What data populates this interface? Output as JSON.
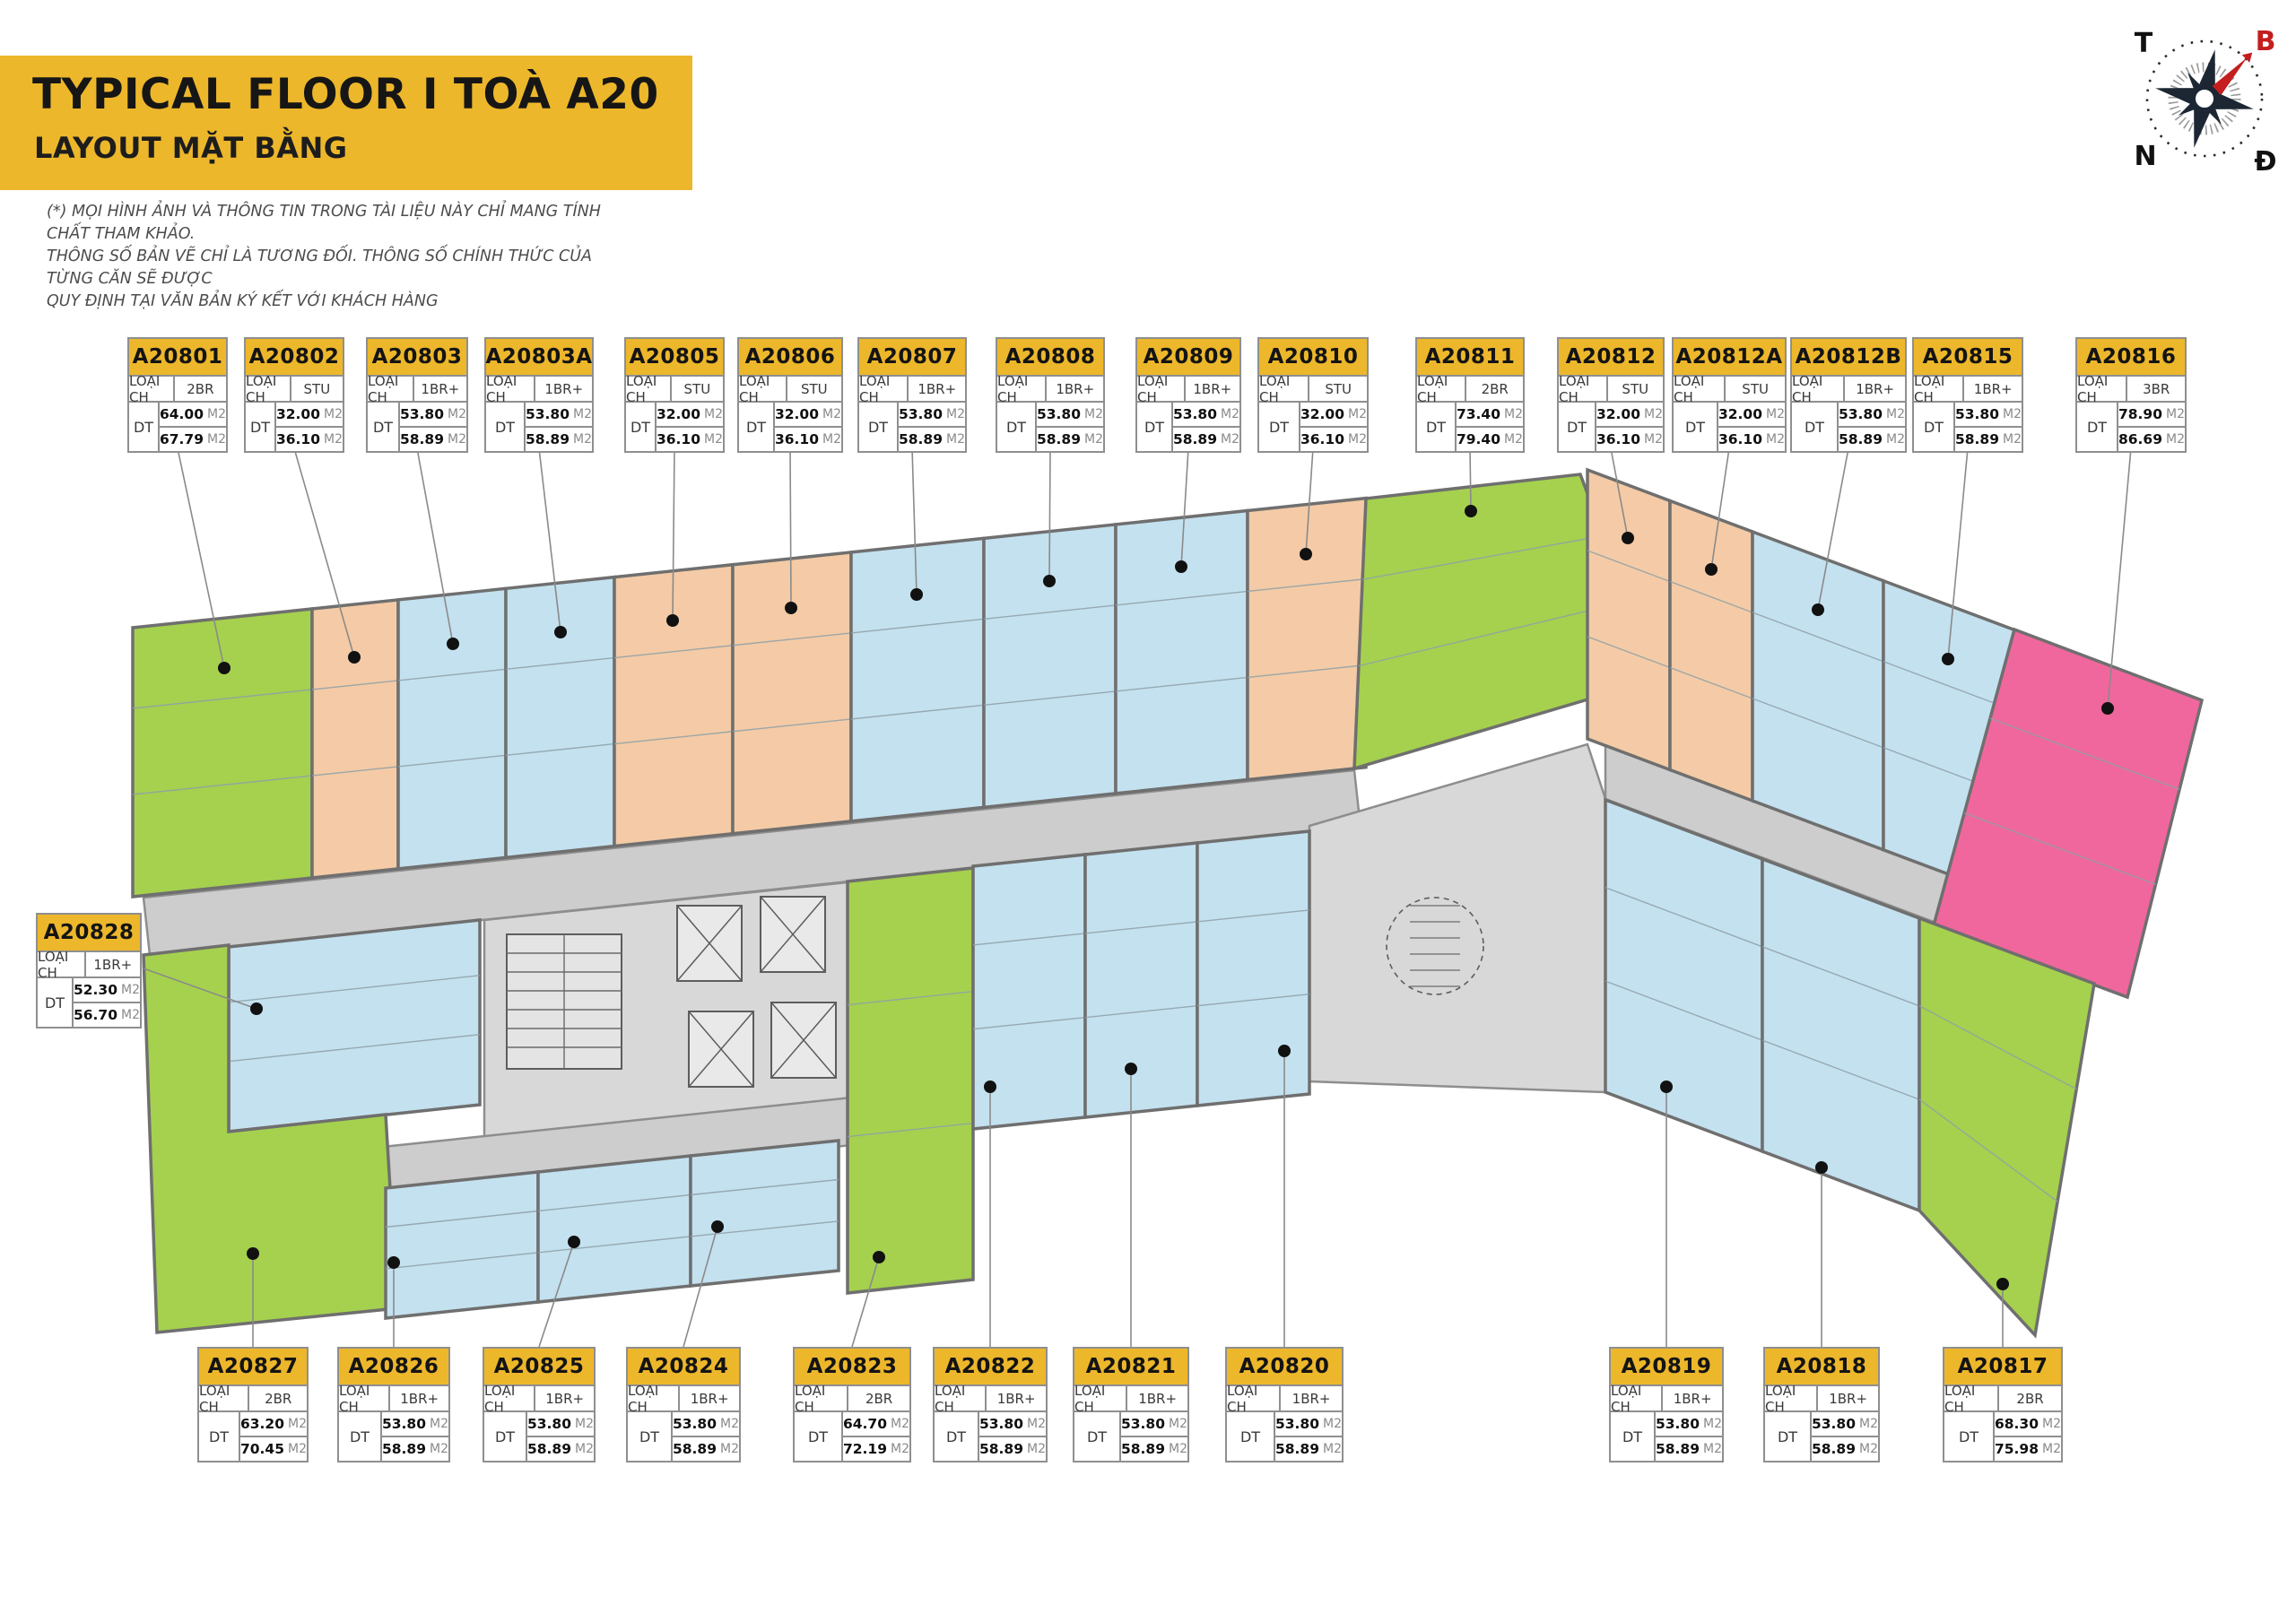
{
  "header": {
    "title": "TYPICAL FLOOR I TOÀ A20",
    "subtitle": "LAYOUT MẶT BẰNG",
    "disclaimer_lines": [
      "(*) MỌI HÌNH ẢNH VÀ THÔNG TIN TRONG TÀI LIỆU NÀY CHỈ MANG TÍNH CHẤT THAM KHẢO.",
      "THÔNG SỐ BẢN VẼ CHỈ LÀ TƯƠNG ĐỐI. THÔNG SỐ CHÍNH THỨC CỦA TỪNG CĂN SẼ ĐƯỢC",
      "QUY ĐỊNH TẠI VĂN BẢN KÝ KẾT VỚI KHÁCH HÀNG"
    ]
  },
  "compass": {
    "west": "T",
    "north": "B",
    "south": "N",
    "east": "Đ"
  },
  "labels": {
    "type_label": "LOẠI CH",
    "area_label": "DT",
    "area_unit": "M2"
  },
  "colors": {
    "banner": "#EDB72B",
    "card_header": "#EDB72B",
    "green": "#A5D14E",
    "blue": "#C4E1EF",
    "orange": "#F4CBA6",
    "pink": "#F0679D",
    "corridor": "#CDCDCD",
    "core": "#D8D8D8",
    "wall": "#6F6F6F",
    "wall_light": "#8E8E8E",
    "inner_line": "#8FA0A8",
    "leader": "#8A8A8A",
    "needle_red": "#C41E1E",
    "compass_dark": "#1C2733"
  },
  "units": [
    {
      "id": "A20801",
      "row": "top",
      "type": "2BR",
      "area1": "64.00",
      "area2": "67.79",
      "color": "green"
    },
    {
      "id": "A20802",
      "row": "top",
      "type": "STU",
      "area1": "32.00",
      "area2": "36.10",
      "color": "orange"
    },
    {
      "id": "A20803",
      "row": "top",
      "type": "1BR+",
      "area1": "53.80",
      "area2": "58.89",
      "color": "blue"
    },
    {
      "id": "A20803A",
      "row": "top",
      "type": "1BR+",
      "area1": "53.80",
      "area2": "58.89",
      "color": "blue"
    },
    {
      "id": "A20805",
      "row": "top",
      "type": "STU",
      "area1": "32.00",
      "area2": "36.10",
      "color": "orange"
    },
    {
      "id": "A20806",
      "row": "top",
      "type": "STU",
      "area1": "32.00",
      "area2": "36.10",
      "color": "orange"
    },
    {
      "id": "A20807",
      "row": "top",
      "type": "1BR+",
      "area1": "53.80",
      "area2": "58.89",
      "color": "blue"
    },
    {
      "id": "A20808",
      "row": "top",
      "type": "1BR+",
      "area1": "53.80",
      "area2": "58.89",
      "color": "blue"
    },
    {
      "id": "A20809",
      "row": "top",
      "type": "1BR+",
      "area1": "53.80",
      "area2": "58.89",
      "color": "blue"
    },
    {
      "id": "A20810",
      "row": "top",
      "type": "STU",
      "area1": "32.00",
      "area2": "36.10",
      "color": "orange"
    },
    {
      "id": "A20811",
      "row": "top",
      "type": "2BR",
      "area1": "73.40",
      "area2": "79.40",
      "color": "green"
    },
    {
      "id": "A20812",
      "row": "top",
      "type": "STU",
      "area1": "32.00",
      "area2": "36.10",
      "color": "orange"
    },
    {
      "id": "A20812A",
      "row": "top",
      "type": "STU",
      "area1": "32.00",
      "area2": "36.10",
      "color": "orange"
    },
    {
      "id": "A20812B",
      "row": "top",
      "type": "1BR+",
      "area1": "53.80",
      "area2": "58.89",
      "color": "blue"
    },
    {
      "id": "A20815",
      "row": "top",
      "type": "1BR+",
      "area1": "53.80",
      "area2": "58.89",
      "color": "blue"
    },
    {
      "id": "A20816",
      "row": "top",
      "type": "3BR",
      "area1": "78.90",
      "area2": "86.69",
      "color": "pink"
    },
    {
      "id": "A20828",
      "row": "left",
      "type": "1BR+",
      "area1": "52.30",
      "area2": "56.70",
      "color": "blue"
    },
    {
      "id": "A20827",
      "row": "bottom",
      "type": "2BR",
      "area1": "63.20",
      "area2": "70.45",
      "color": "green"
    },
    {
      "id": "A20826",
      "row": "bottom",
      "type": "1BR+",
      "area1": "53.80",
      "area2": "58.89",
      "color": "blue"
    },
    {
      "id": "A20825",
      "row": "bottom",
      "type": "1BR+",
      "area1": "53.80",
      "area2": "58.89",
      "color": "blue"
    },
    {
      "id": "A20824",
      "row": "bottom",
      "type": "1BR+",
      "area1": "53.80",
      "area2": "58.89",
      "color": "blue"
    },
    {
      "id": "A20823",
      "row": "bottom",
      "type": "2BR",
      "area1": "64.70",
      "area2": "72.19",
      "color": "green"
    },
    {
      "id": "A20822",
      "row": "bottom",
      "type": "1BR+",
      "area1": "53.80",
      "area2": "58.89",
      "color": "blue"
    },
    {
      "id": "A20821",
      "row": "bottom",
      "type": "1BR+",
      "area1": "53.80",
      "area2": "58.89",
      "color": "blue"
    },
    {
      "id": "A20820",
      "row": "bottom",
      "type": "1BR+",
      "area1": "53.80",
      "area2": "58.89",
      "color": "blue"
    },
    {
      "id": "A20819",
      "row": "bottom",
      "type": "1BR+",
      "area1": "53.80",
      "area2": "58.89",
      "color": "blue"
    },
    {
      "id": "A20818",
      "row": "bottom",
      "type": "1BR+",
      "area1": "53.80",
      "area2": "58.89",
      "color": "blue"
    },
    {
      "id": "A20817",
      "row": "bottom",
      "type": "2BR",
      "area1": "68.30",
      "area2": "75.98",
      "color": "green"
    }
  ]
}
